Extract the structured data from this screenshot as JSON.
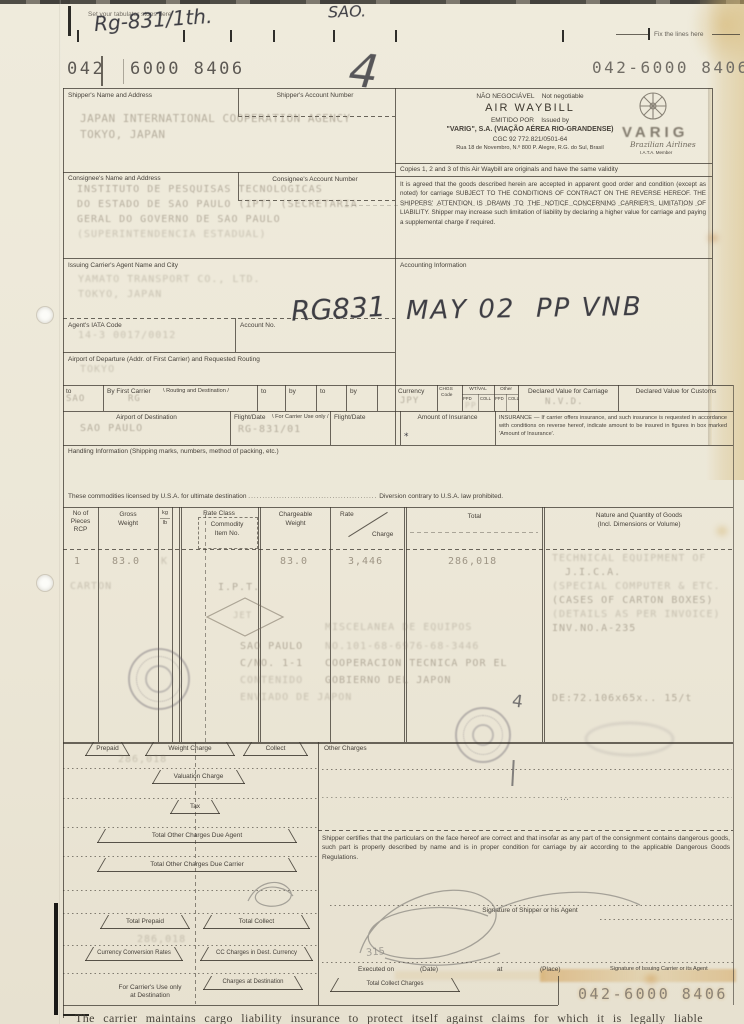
{
  "colors": {
    "paper": "#ebe7d8",
    "ink": "#46413a",
    "typed_ink": "#7d7261",
    "stain": "#cf9f55",
    "pencil": "#8e8b84"
  },
  "top": {
    "tabulator_note": "Set your tabulator stops here",
    "fix_lines_note": "Fix the lines here",
    "hand_ref": "Rg-831/1th.",
    "hand_sao": "SAO.",
    "hand_four": "4"
  },
  "awb": {
    "prefix": "042",
    "serial": "6000 8406",
    "stamp_top_right": "042-6000 8406",
    "stamp_bottom_right": "042-6000 8406"
  },
  "shipper": {
    "label": "Shipper's Name and Address",
    "account_label": "Shipper's Account Number",
    "line1": "JAPAN INTERNATIONAL COOPERATION AGENCY",
    "line2": "TOKYO, JAPAN"
  },
  "consignee": {
    "label": "Consignee's Name and Address",
    "account_label": "Consignee's Account Number",
    "line1": "INSTITUTO DE PESQUISAS TECNOLOGICAS",
    "line2": "DO ESTADO DE SAO PAULO (IPT) (SECRETARIA",
    "line3": "GERAL DO GOVERNO DE SAO PAULO",
    "line4": "(SUPERINTENDENCIA ESTADUAL)"
  },
  "waybill_header": {
    "nao_negociavel": "NÃO NEGOCIÁVEL",
    "not_negotiable": "Not negotiable",
    "title": "AIR WAYBILL",
    "emitido_por": "EMITIDO POR",
    "issued_by": "Issued by",
    "company": "\"VARIG\", S.A. (VIAÇÃO AÉREA RIO-GRANDENSE)",
    "cgc": "CGC 92 772.821/0501-64",
    "address": "Rua 18 de Novembro, N.º 800 P. Alegre, R.G. do Sul, Brasil",
    "copies_note": "Copies 1, 2 and 3 of this Air Waybill are originals and have the same validity",
    "conditions": "It is agreed that the goods described herein are accepted in apparent good order and condition (except as noted) for carriage SUBJECT TO THE CONDITIONS OF CONTRACT ON THE REVERSE HEREOF. THE SHIPPERS' ATTENTION IS DRAWN TO THE NOTICE CONCERNING CARRIER'S LIMITATION OF LIABILITY. Shipper may increase such limitation of liability by declaring a higher value for carriage and paying a supplemental charge if required.",
    "brand": "VARIG",
    "brand_script": "Brazilian Airlines",
    "iata_member": "I.A.T.A. Member"
  },
  "agent": {
    "label": "Issuing Carrier's Agent Name and City",
    "line1": "YAMATO TRANSPORT CO., LTD.",
    "line2": "TOKYO, JAPAN",
    "iata_label": "Agent's IATA Code",
    "iata_code": "14-3 0017/0012",
    "account_label": "Account No.",
    "hand_rg": "RG831"
  },
  "accounting": {
    "label": "Accounting Information",
    "handwritten": "MAY 02  PP VNB"
  },
  "departure": {
    "label": "Airport of Departure (Addr. of First Carrier) and Requested Routing",
    "value": "TOKYO"
  },
  "routing": {
    "to_label": "to",
    "to_value": "SAO",
    "first_carrier_label": "By First Carrier",
    "routing_dest_label": "Routing and Destination",
    "first_carrier_value": "RG",
    "to2_label": "to",
    "by2_label": "by",
    "to3_label": "to",
    "by3_label": "by",
    "currency_label": "Currency",
    "currency_value": "JPY",
    "chgs_label": "CHGS",
    "code_label": "Code",
    "wtval_label": "WT/VAL",
    "other_label": "Other",
    "ppd_label": "PPD",
    "coll_label": "COLL",
    "wtval_value": "PP",
    "dv_carriage_label": "Declared Value for Carriage",
    "dv_carriage_value": "N.V.D.",
    "dv_customs_label": "Declared Value for Customs"
  },
  "destination": {
    "label": "Airport of Destination",
    "value": "SAO PAULO",
    "flight_label": "Flight/Date",
    "carrier_use_label": "For Carrier Use only",
    "flight_value": "RG-831/01",
    "flight2_label": "Flight/Date",
    "insurance_label": "Amount of Insurance",
    "insurance_note": "INSURANCE — If carrier offers insurance, and such insurance is requested in accordance with conditions on reverse hereof, indicate amount to be insured in figures in box marked 'Amount of Insurance'."
  },
  "handling": {
    "label": "Handling Information (Shipping marks, numbers, method of packing, etc.)"
  },
  "commodities": {
    "prefix": "These commodities licensed by U.S.A. for ultimate destination",
    "dots": "..............................................",
    "suffix": "Diversion contrary to U.S.A. law prohibited."
  },
  "table": {
    "headers": {
      "pieces1": "No of",
      "pieces2": "Pieces",
      "pieces3": "RCP",
      "gross1": "Gross",
      "gross2": "Weight",
      "kg": "kg",
      "lb": "lb",
      "rate_class": "Rate Class",
      "commodity1": "Commodity",
      "commodity2": "Item No.",
      "chargeable1": "Chargeable",
      "chargeable2": "Weight",
      "rate": "Rate",
      "charge": "Charge",
      "total": "Total",
      "nature1": "Nature and Quantity of Goods",
      "nature2": "(Incl. Dimensions or Volume)"
    },
    "row": {
      "pieces": "1",
      "gross_weight": "83.0",
      "kg_code": "K",
      "chargeable_weight": "83.0",
      "rate": "3,446",
      "total": "286,018"
    },
    "goods": {
      "l1": "TECHNICAL EQUIPMENT OF",
      "l2": "J.I.C.A.",
      "l3": "(SPECIAL COMPUTER & ETC.",
      "l4": "(CASES OF CARTON BOXES)",
      "l5": "(DETAILS AS PER INVOICE)",
      "l6": "INV.NO.A-235",
      "dims": "DE:72.106x65x.. 15/t"
    },
    "marks": {
      "carton": "CARTON",
      "ipt": "I.P.T.",
      "diamond": "JET",
      "m1": "MISCELANEA DE EQUIPOS",
      "m2a": "SAO PAULO",
      "m2b": "NO.101-68-6976-68-3446",
      "m3a": "C/NO. 1-1",
      "m3b": "COOPERACION TECNICA POR EL",
      "m4a": "CONTENIDO",
      "m4b": "GOBIERNO DEL JAPON",
      "m5": "ENVIADO DE JAPON",
      "hand_mark": "4"
    }
  },
  "charges": {
    "prepaid_label": "Prepaid",
    "weight_charge_label": "Weight Charge",
    "collect_label": "Collect",
    "other_charges_label": "Other Charges",
    "weight_charge_value": "286,018",
    "valuation_label": "Valuation Charge",
    "tax_label": "Tax",
    "due_agent_label": "Total Other Charges Due Agent",
    "due_carrier_label": "Total Other Charges Due Carrier",
    "total_prepaid_label": "Total Prepaid",
    "total_collect_label": "Total Collect",
    "total_prepaid_value": "286,018",
    "conversion_label": "Currency Conversion Rates",
    "cc_dest_label": "CC Charges in Dest. Currency",
    "carrier_use_label1": "For Carrier's Use only",
    "carrier_use_label2": "at Destination",
    "charges_dest_label": "Charges at Destination",
    "total_collect_charges_label": "Total Collect Charges"
  },
  "certification": {
    "text": "Shipper certifies that the particulars on the face hereof are correct and that insofar as any part of the consignment contains dangerous goods, such part is properly described by name and is in proper condition for carriage by air according to the applicable Dangerous Goods Regulations."
  },
  "signatures": {
    "shipper_sig_label": "Signature of Shipper or his Agent",
    "executed_label": "Executed on",
    "date_label": "(Date)",
    "at_label": "at",
    "place_label": "(Place)",
    "carrier_sig_label": "Signature of Issuing Carrier or its Agent",
    "pencil_note": "315"
  },
  "footer": {
    "text": "The carrier maintains cargo liability insurance to protect itself against claims for which it is legally liable"
  }
}
